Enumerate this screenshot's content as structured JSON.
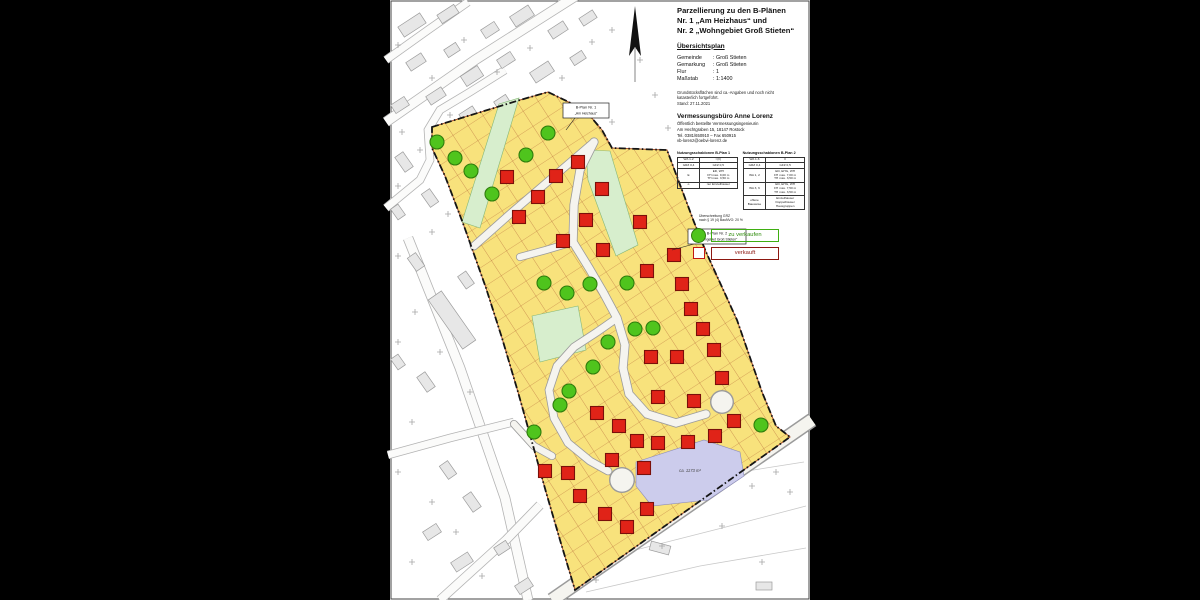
{
  "title_block": {
    "title": "Parzellierung zu den B-Plänen\nNr. 1 „Am Heizhaus“  und\nNr. 2 „Wohngebiet Groß Stieten“",
    "subtitle": "Übersichtsplan"
  },
  "info": {
    "rows": [
      {
        "k": "Gemeinde",
        "v": ": Groß Stieten"
      },
      {
        "k": "Gemarkung",
        "v": ": Groß Stieten"
      },
      {
        "k": "Flur",
        "v": ": 1"
      },
      {
        "k": "Maßstab",
        "v": ": 1:1400"
      }
    ],
    "note": "Grundstücksflächen sind ca.-Angaben und noch nicht\nkatasterlich fortgeführt.\nStand: 27.11.2021"
  },
  "surveyor": {
    "name": "Vermessungsbüro Anne Lorenz",
    "lines": "Öffentlich bestellte Vermessungsingenieurin\nAm Hechtgraben 15, 18147 Rostock\nTel. 0381/650910 – Fax 650915\nvb-lorenz@oebvi-lorenz.de"
  },
  "tables": {
    "t1": {
      "title": "Nutzungsschablonen B-Plan 1",
      "rows": [
        [
          "WA 1-2",
          "I (II)"
        ],
        [
          "GRZ 0,4",
          "GFZ 0,5"
        ],
        [
          "E",
          "ED, WH\nFH max. 9,00 m\nTH max. 3,50 m"
        ],
        [
          "o",
          "nur Einzelhäuser"
        ]
      ]
    },
    "t2": {
      "title": "Nutzungsschablonen B-Plan 2",
      "rows": [
        [
          "WA 1-6",
          "II"
        ],
        [
          "GRZ 0,4",
          "GFZ 0,5"
        ],
        [
          "WA 1, 2",
          "ED, EHG, WH\nFH max. 7,00 m\nTH max. 3,50 m"
        ],
        [
          "WA 3, 6",
          "ED, EHG, WH\nFH max. 7,50 m\nTH max. 3,50 m"
        ],
        [
          "offene\nBauweise",
          "Einzelhäuser\nDoppelhäuser\nHausgruppen"
        ]
      ]
    },
    "grz_note": "Überschreitung GRZ\nnach § 19 (4) BauNVO: 20 %"
  },
  "legend": {
    "for_sale": {
      "label": "zu verkaufen",
      "color": "#4fc41d"
    },
    "sold": {
      "label": "verkauft",
      "color": "#c01911"
    }
  },
  "map": {
    "colors": {
      "page": "#ffffff",
      "plot_fill": "#f8e27c",
      "parcel_line": "#a8502a",
      "green_area": "#d7eecd",
      "green_edge": "#86b878",
      "lavender": "#ccccec",
      "lavender_edge": "#8a8abb",
      "road_fill": "#f5f4ef",
      "road_casing": "#9b9b9b",
      "boundary": "#141414",
      "sold": "#e02318",
      "sold_edge": "#7a100a",
      "for_sale": "#4fc41d",
      "for_sale_edge": "#2f7d0c",
      "building_fill": "#e7e7e7",
      "building_edge": "#9c9c9c"
    },
    "boundary": [
      [
        432,
        127
      ],
      [
        520,
        100
      ],
      [
        548,
        92
      ],
      [
        585,
        110
      ],
      [
        602,
        130
      ],
      [
        612,
        148
      ],
      [
        667,
        150
      ],
      [
        694,
        222
      ],
      [
        706,
        252
      ],
      [
        737,
        320
      ],
      [
        762,
        392
      ],
      [
        776,
        426
      ],
      [
        790,
        437
      ],
      [
        575,
        590
      ],
      [
        560,
        540
      ],
      [
        546,
        492
      ],
      [
        532,
        442
      ],
      [
        518,
        392
      ],
      [
        502,
        338
      ],
      [
        486,
        288
      ],
      [
        464,
        226
      ],
      [
        445,
        176
      ],
      [
        432,
        148
      ]
    ],
    "green_areas": [
      [
        [
          586,
          150
        ],
        [
          610,
          151
        ],
        [
          638,
          245
        ],
        [
          616,
          256
        ],
        [
          588,
          180
        ]
      ],
      [
        [
          499,
          104
        ],
        [
          519,
          98
        ],
        [
          480,
          228
        ],
        [
          462,
          222
        ]
      ],
      [
        [
          532,
          316
        ],
        [
          578,
          306
        ],
        [
          586,
          350
        ],
        [
          540,
          362
        ]
      ]
    ],
    "lavender": {
      "points": [
        [
          636,
          462
        ],
        [
          704,
          440
        ],
        [
          740,
          452
        ],
        [
          744,
          476
        ],
        [
          708,
          500
        ],
        [
          652,
          506
        ],
        [
          636,
          486
        ]
      ],
      "label": "ca. 1173 m²",
      "label_pos": [
        690,
        472
      ]
    },
    "roads": [
      {
        "w": 7,
        "pts": [
          [
            594,
            142
          ],
          [
            552,
            178
          ],
          [
            510,
            214
          ],
          [
            474,
            246
          ]
        ]
      },
      {
        "w": 7.5,
        "pts": [
          [
            594,
            142
          ],
          [
            580,
            170
          ],
          [
            574,
            205
          ],
          [
            573,
            242
          ],
          [
            589,
            268
          ],
          [
            603,
            292
          ],
          [
            617,
            318
          ],
          [
            625,
            345
          ],
          [
            623,
            368
          ],
          [
            629,
            394
          ],
          [
            647,
            414
          ],
          [
            676,
            423
          ],
          [
            706,
            414
          ]
        ]
      },
      {
        "w": 7,
        "pts": [
          [
            617,
            318
          ],
          [
            597,
            332
          ],
          [
            574,
            347
          ],
          [
            557,
            366
          ],
          [
            549,
            390
          ],
          [
            554,
            418
          ],
          [
            568,
            443
          ],
          [
            590,
            461
          ],
          [
            608,
            471
          ]
        ]
      },
      {
        "w": 6.5,
        "pts": [
          [
            573,
            242
          ],
          [
            546,
            250
          ],
          [
            520,
            257
          ]
        ]
      },
      {
        "w": 6.5,
        "pts": [
          [
            514,
            424
          ],
          [
            534,
            446
          ],
          [
            552,
            456
          ]
        ]
      }
    ],
    "culdesacs": [
      [
        722,
        402,
        12
      ],
      [
        622,
        480,
        13
      ]
    ],
    "main_road": [
      [
        552,
        600
      ],
      [
        812,
        420
      ]
    ],
    "markers": {
      "for_sale": [
        [
          437,
          142
        ],
        [
          455,
          158
        ],
        [
          471,
          171
        ],
        [
          492,
          194
        ],
        [
          526,
          155
        ],
        [
          548,
          133
        ],
        [
          544,
          283
        ],
        [
          567,
          293
        ],
        [
          590,
          284
        ],
        [
          627,
          283
        ],
        [
          635,
          329
        ],
        [
          653,
          328
        ],
        [
          608,
          342
        ],
        [
          593,
          367
        ],
        [
          569,
          391
        ],
        [
          560,
          405
        ],
        [
          534,
          432
        ],
        [
          761,
          425
        ]
      ],
      "sold": [
        [
          507,
          177
        ],
        [
          519,
          217
        ],
        [
          538,
          197
        ],
        [
          556,
          176
        ],
        [
          578,
          162
        ],
        [
          602,
          189
        ],
        [
          586,
          220
        ],
        [
          563,
          241
        ],
        [
          603,
          250
        ],
        [
          640,
          222
        ],
        [
          674,
          255
        ],
        [
          647,
          271
        ],
        [
          682,
          284
        ],
        [
          691,
          309
        ],
        [
          703,
          329
        ],
        [
          714,
          350
        ],
        [
          677,
          357
        ],
        [
          651,
          357
        ],
        [
          658,
          397
        ],
        [
          694,
          401
        ],
        [
          722,
          378
        ],
        [
          597,
          413
        ],
        [
          619,
          426
        ],
        [
          637,
          441
        ],
        [
          658,
          443
        ],
        [
          688,
          442
        ],
        [
          715,
          436
        ],
        [
          734,
          421
        ],
        [
          545,
          471
        ],
        [
          568,
          473
        ],
        [
          580,
          496
        ],
        [
          605,
          514
        ],
        [
          627,
          527
        ],
        [
          612,
          460
        ],
        [
          644,
          468
        ],
        [
          647,
          509
        ]
      ]
    },
    "labels": [
      {
        "x": 563,
        "y": 103,
        "w": 46,
        "h": 15,
        "l1": "B-Plan Nr. 1",
        "l2": "„Am Heizhaus“",
        "leader": [
          [
            575,
            118
          ],
          [
            566,
            130
          ]
        ]
      },
      {
        "x": 688,
        "y": 229,
        "w": 58,
        "h": 15,
        "l1": "B-Plan Nr. 2",
        "l2": "„Wohngebiet Groß Stieten“",
        "leader": [
          [
            694,
            244
          ],
          [
            672,
            250
          ]
        ]
      }
    ],
    "village": {
      "streets": [
        {
          "w": 9,
          "pts": [
            [
              386,
              122
            ],
            [
              475,
              60
            ],
            [
              582,
              -8
            ]
          ]
        },
        {
          "w": 7,
          "pts": [
            [
              386,
              208
            ],
            [
              420,
              180
            ],
            [
              430,
              160
            ],
            [
              428,
              130
            ],
            [
              440,
              110
            ],
            [
              470,
              92
            ],
            [
              505,
              70
            ]
          ]
        },
        {
          "w": 9,
          "pts": [
            [
              408,
              238
            ],
            [
              460,
              368
            ],
            [
              505,
              498
            ],
            [
              528,
              600
            ]
          ]
        },
        {
          "w": 7,
          "pts": [
            [
              388,
              455
            ],
            [
              450,
              438
            ],
            [
              514,
              422
            ]
          ]
        },
        {
          "w": 8,
          "pts": [
            [
              440,
              600
            ],
            [
              506,
              540
            ],
            [
              540,
              505
            ]
          ]
        },
        {
          "w": 7,
          "pts": [
            [
              386,
              60
            ],
            [
              428,
              30
            ],
            [
              468,
              2
            ]
          ]
        }
      ],
      "buildings": [
        [
          412,
          25,
          26,
          12,
          -33
        ],
        [
          448,
          14,
          20,
          10,
          -33
        ],
        [
          490,
          30,
          16,
          10,
          -33
        ],
        [
          522,
          16,
          22,
          12,
          -33
        ],
        [
          558,
          30,
          18,
          10,
          -33
        ],
        [
          588,
          18,
          16,
          9,
          -33
        ],
        [
          416,
          62,
          18,
          10,
          -33
        ],
        [
          452,
          50,
          14,
          9,
          -33
        ],
        [
          472,
          76,
          20,
          12,
          -33
        ],
        [
          506,
          60,
          16,
          10,
          -33
        ],
        [
          542,
          72,
          22,
          12,
          -33
        ],
        [
          578,
          58,
          14,
          9,
          -33
        ],
        [
          400,
          105,
          16,
          10,
          -33
        ],
        [
          436,
          96,
          18,
          10,
          -33
        ],
        [
          468,
          114,
          16,
          9,
          -33
        ],
        [
          502,
          102,
          14,
          9,
          -33
        ],
        [
          404,
          162,
          18,
          10,
          55
        ],
        [
          430,
          198,
          16,
          10,
          55
        ],
        [
          398,
          212,
          13,
          9,
          55
        ],
        [
          416,
          262,
          16,
          10,
          55
        ],
        [
          452,
          320,
          60,
          16,
          55
        ],
        [
          466,
          280,
          15,
          10,
          55
        ],
        [
          426,
          382,
          18,
          10,
          55
        ],
        [
          398,
          362,
          13,
          9,
          55
        ],
        [
          448,
          470,
          16,
          10,
          55
        ],
        [
          472,
          502,
          18,
          10,
          55
        ],
        [
          432,
          532,
          16,
          10,
          -33
        ],
        [
          462,
          562,
          20,
          11,
          -33
        ],
        [
          502,
          548,
          14,
          9,
          -33
        ],
        [
          524,
          586,
          16,
          10,
          -33
        ],
        [
          660,
          548,
          20,
          9,
          15
        ],
        [
          764,
          586,
          16,
          8,
          0
        ]
      ],
      "crosses": [
        [
          398,
          45
        ],
        [
          432,
          78
        ],
        [
          464,
          40
        ],
        [
          497,
          72
        ],
        [
          530,
          48
        ],
        [
          562,
          78
        ],
        [
          592,
          42
        ],
        [
          402,
          132
        ],
        [
          420,
          150
        ],
        [
          450,
          115
        ],
        [
          398,
          186
        ],
        [
          432,
          232
        ],
        [
          398,
          256
        ],
        [
          448,
          214
        ],
        [
          415,
          312
        ],
        [
          398,
          342
        ],
        [
          470,
          392
        ],
        [
          440,
          352
        ],
        [
          412,
          422
        ],
        [
          398,
          472
        ],
        [
          432,
          502
        ],
        [
          456,
          532
        ],
        [
          412,
          562
        ],
        [
          482,
          576
        ],
        [
          612,
          30
        ],
        [
          655,
          95
        ],
        [
          668,
          128
        ],
        [
          612,
          122
        ],
        [
          640,
          60
        ],
        [
          776,
          472
        ],
        [
          722,
          526
        ],
        [
          762,
          562
        ],
        [
          662,
          546
        ],
        [
          596,
          580
        ],
        [
          790,
          492
        ],
        [
          752,
          486
        ]
      ],
      "field_lines": [
        [
          [
            596,
            505
          ],
          [
            690,
            480
          ],
          [
            804,
            462
          ]
        ],
        [
          [
            612,
            556
          ],
          [
            722,
            528
          ],
          [
            806,
            506
          ]
        ],
        [
          [
            586,
            592
          ],
          [
            700,
            566
          ],
          [
            806,
            548
          ]
        ]
      ]
    },
    "north_arrow": {
      "tip": [
        635,
        6
      ],
      "base": 50,
      "tail_end": 76
    }
  }
}
